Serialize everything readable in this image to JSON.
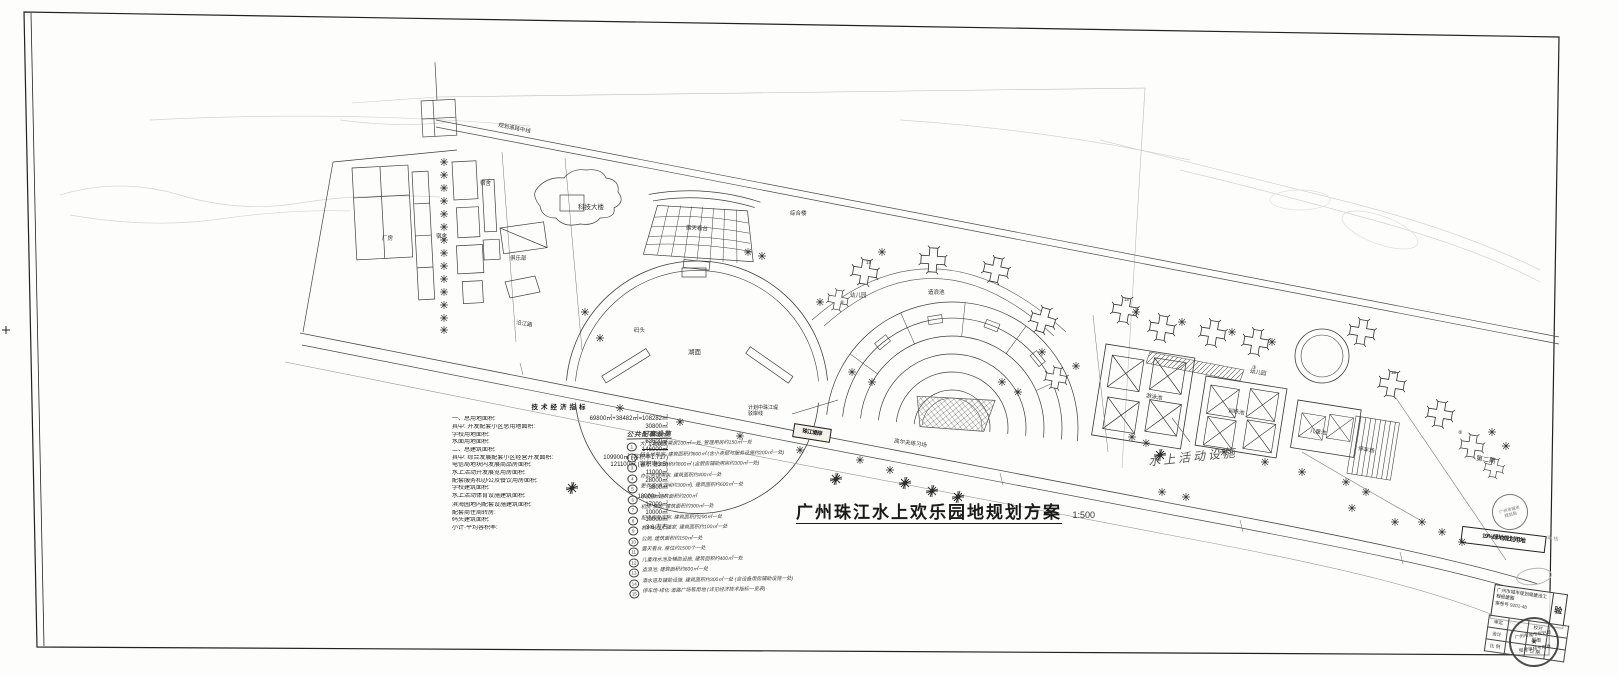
{
  "sheet": {
    "title": "广州珠江水上欢乐园地规划方案",
    "scale": "1:500"
  },
  "indicators": {
    "title": "技术经济指标",
    "rows": [
      {
        "label": "一、总用地面积:",
        "value": "69800㎡+38482㎡=108282㎡"
      },
      {
        "label": "其中: 开发配套小区总用地面积:",
        "value": "30800㎡"
      },
      {
        "label": "学校用地面积:",
        "value": "7080㎡"
      },
      {
        "label": "水面用地面积:",
        "value": "63600㎡"
      },
      {
        "label": "二、总建筑面积:",
        "value": "146000㎡",
        "note": "140000"
      },
      {
        "label": "其中: 综合发展配套小区经营开发面积:",
        "value": "109900㎡ (容积率1.717)"
      },
      {
        "label": "电信局地块内发展商品房面积:",
        "value": "121100㎡ (容积率3.5)"
      },
      {
        "label": "水上活动开发展览用房面积:",
        "value": "11000㎡"
      },
      {
        "label": "配套服务和办公及餐饮用房面积:",
        "value": "28000㎡"
      },
      {
        "label": "学校建筑面积:",
        "value": "3800㎡"
      },
      {
        "label": "水上活动体育设施建筑面积:",
        "value": "18000㎡",
        "mark": "✓"
      },
      {
        "label": "滨海园地内配套设施建筑面积:",
        "value": "17000㎡"
      },
      {
        "label": "配套商住周转房:",
        "value": "10000㎡"
      },
      {
        "label": "码头建筑面积:",
        "value": "10000㎡"
      },
      {
        "label": "小计·平均容积率:",
        "value": "3.6 左右"
      }
    ]
  },
  "legend": {
    "title": "公共配套设施",
    "items": [
      {
        "n": "1",
        "t": "大门, 附设售票房100㎡一处, 管理用房约150㎡一处"
      },
      {
        "n": "2",
        "t": "码头候船室, 建筑面积约600㎡ (含小卖部与服务设施约200㎡一处)"
      },
      {
        "n": "3",
        "t": "餐厅, 建筑面积约800㎡ (含厨房辅助用房约300㎡一处)"
      },
      {
        "n": "4",
        "t": "办公管理用房, 建筑面积约400㎡一处"
      },
      {
        "n": "5",
        "t": "更衣室(淋浴间约300㎡), 建筑面积约600㎡一处"
      },
      {
        "n": "6",
        "t": "小卖部, 建筑面积约200㎡"
      },
      {
        "n": "7",
        "t": "机房·泵房, 建筑面积约300㎡一处"
      },
      {
        "n": "8",
        "t": "配电房及库房, 建筑面积约200㎡一处"
      },
      {
        "n": "9",
        "t": "救护站与广播室, 建筑面积约100㎡一处"
      },
      {
        "n": "10",
        "t": "公厕, 建筑面积约150㎡一处"
      },
      {
        "n": "11",
        "t": "露天看台, 座位约1500个一处"
      },
      {
        "n": "12",
        "t": "儿童戏水池及辅助设施, 建筑面积约400㎡一处"
      },
      {
        "n": "13",
        "t": "造浪池, 建筑面积约600㎡一处"
      },
      {
        "n": "14",
        "t": "滑水道及辅助设施, 建筑面积约300㎡一处 (含设备用房辅助设施一处)"
      },
      {
        "n": "15",
        "t": "停车场·绿化·道路广场等用地 (详见经济技术指标一览表)"
      }
    ]
  },
  "notes": {
    "handwritten": "水上活动设施",
    "embankment_line1": "计划中珠江堤",
    "embankment_line2": "驳岸线",
    "river_box": "珠江堤岸"
  },
  "plan_labels": [
    {
      "t": "科技大楼"
    },
    {
      "t": "宿舍"
    },
    {
      "t": "宿舍"
    },
    {
      "t": "厂房"
    },
    {
      "t": "俱乐部"
    },
    {
      "t": "综合楼"
    },
    {
      "t": "露天看台"
    },
    {
      "t": "湖面"
    },
    {
      "t": "码头"
    },
    {
      "t": "幼儿园"
    },
    {
      "t": "幼儿园"
    },
    {
      "t": "造浪池"
    },
    {
      "t": "高尔夫练习场"
    },
    {
      "t": "游泳池"
    },
    {
      "t": "训练池"
    },
    {
      "t": "儿童池"
    },
    {
      "t": "停车场"
    },
    {
      "t": "第二期"
    },
    {
      "t": "沿江路"
    },
    {
      "t": "规划道路中线"
    },
    {
      "t": "18"
    },
    {
      "t": "18"
    },
    {
      "t": "18"
    },
    {
      "t": "⑥"
    },
    {
      "t": "③"
    },
    {
      "t": "⑨"
    }
  ],
  "titleblock": {
    "approval": "19%绿地规划用地",
    "approval_side": "审 核",
    "permit_line1": "广州市城市规划局建设工程报建图",
    "permit_line2": "案卷号 9201-48",
    "permit_seal": "验",
    "stamp_top_l1": "广州市城市",
    "stamp_top_l2": "规划局",
    "stamp_main_l1": "广州市城市规划局",
    "stamp_main_star": "★",
    "stamp_main_l2": "报建审核专用章",
    "grid_cells": [
      "审定",
      "校对",
      "设计",
      "绘图",
      "比 例",
      "日 期"
    ]
  }
}
